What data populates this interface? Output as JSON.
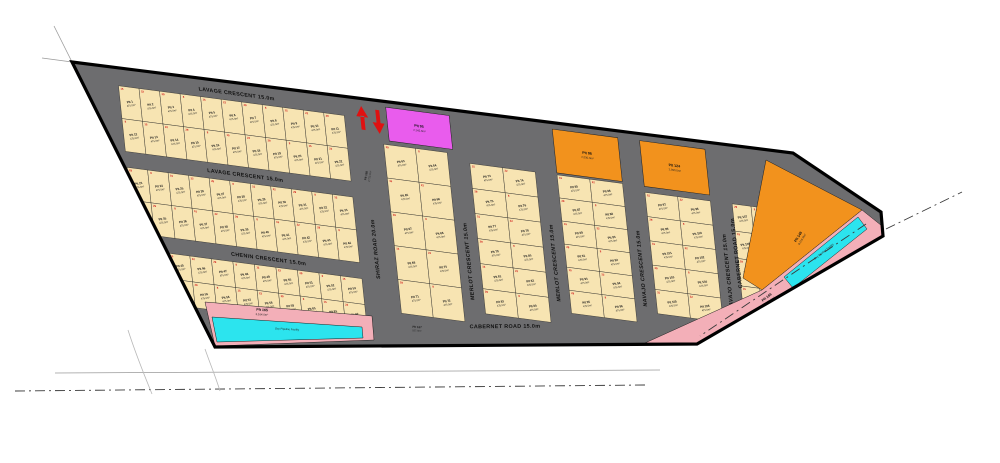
{
  "map": {
    "type": "subdivision-plat-plan",
    "canvas": {
      "width": 1000,
      "height": 463
    },
    "colors": {
      "background": "#ffffff",
      "road": "#6d6d6f",
      "lot_fill": "#f7e4b2",
      "lot_border": "#1f1f1f",
      "magenta": "#e95ced",
      "orange": "#f2921d",
      "pink": "#f3afb8",
      "cyan": "#2ce4ee",
      "red_mark": "#cf1010",
      "arrow_red": "#e01111",
      "boundary": "#000000",
      "survey_line": "#9a9a9a",
      "centerline": "#3a3a3a"
    },
    "boundary": {
      "points": [
        [
          72,
          62
        ],
        [
          793,
          153
        ],
        [
          881,
          212
        ],
        [
          883,
          236
        ],
        [
          697,
          344
        ],
        [
          215,
          347
        ]
      ],
      "stroke_width": 3.2
    },
    "grid_transform": {
      "matrix": [
        0.9914,
        0.1305,
        0.1045,
        0.9945,
        -5.86,
        -9.06
      ]
    },
    "lot": {
      "prefix": "Plt",
      "area_label": "475.0m²"
    },
    "blocks": [
      {
        "id": "lavage-north",
        "x": 117,
        "y": 80,
        "cols": 11,
        "rows": 2,
        "lot_w": 20.7,
        "lot_h": 33,
        "start": 1
      },
      {
        "id": "lavage-south",
        "x": 117,
        "y": 162,
        "cols": 11,
        "rows": 2,
        "lot_w": 20.7,
        "lot_h": 33,
        "start": 23
      },
      {
        "id": "chenin-block",
        "x": 150,
        "y": 244,
        "cols": 9,
        "rows": 2,
        "lot_w": 21.7,
        "lot_h": 26,
        "start": 45
      },
      {
        "id": "col-1",
        "x": 382,
        "y": 104,
        "cols": 2,
        "rows": 5,
        "lot_w": 32,
        "lot_h": 34,
        "start": 63
      },
      {
        "id": "col-2",
        "x": 468,
        "y": 112,
        "cols": 2,
        "rows": 6,
        "lot_w": 33,
        "lot_h": 25.2,
        "start": 73
      },
      {
        "id": "col-3",
        "x": 556,
        "y": 112,
        "cols": 2,
        "rows": 6,
        "lot_w": 33,
        "lot_h": 23.2,
        "start": 85
      },
      {
        "id": "col-4",
        "x": 644,
        "y": 118,
        "cols": 2,
        "rows": 5,
        "lot_w": 33,
        "lot_h": 24.4,
        "start": 97
      },
      {
        "id": "col-5",
        "x": 732,
        "y": 118,
        "cols": 2,
        "rows": 4,
        "lot_w": 19,
        "lot_h": 27.5,
        "start": 107
      }
    ],
    "street_labels_local": [
      {
        "name": "LAVAGE CRESCENT 15.0m",
        "x": 237,
        "y": 74,
        "rotate": 0
      },
      {
        "name": "LAVAGE CRESCENT 15.0m",
        "x": 237,
        "y": 156,
        "rotate": 0
      },
      {
        "name": "CHENIN CRESCENT 15.0m",
        "x": 252,
        "y": 238,
        "rotate": 0
      },
      {
        "name": "CHENIN CRESCENT 15.0m",
        "x": 268,
        "y": 305,
        "rotate": 0
      },
      {
        "name": "SHIRAZ ROAD 20.0m",
        "x": 364,
        "y": 212,
        "rotate": -90
      },
      {
        "name": "MERLOT CRESCENT 15.0m",
        "x": 458,
        "y": 212,
        "rotate": -90
      },
      {
        "name": "MERLOT CRESCENT 15.0m",
        "x": 546,
        "y": 202,
        "rotate": -90
      },
      {
        "name": "NAVAJO CRESCENT 15.0m",
        "x": 634,
        "y": 196,
        "rotate": -90
      },
      {
        "name": "NAVAJO CRESCENT 15.0m",
        "x": 722,
        "y": 188,
        "rotate": -90
      }
    ],
    "street_labels_screen": [
      {
        "name": "CABERNET ROAD 15.0m",
        "x": 738,
        "y": 253,
        "rotate": -97
      },
      {
        "name": "CABERNET ROAD 15.0m",
        "x": 505,
        "y": 328,
        "rotate": -0.5
      }
    ],
    "special_plots_local": [
      {
        "id": "magenta-plot",
        "fill": "magenta",
        "x": 388,
        "y": 66,
        "w": 64,
        "h": 34,
        "lines": [
          "Plt 95",
          "2,145.0m²"
        ]
      },
      {
        "id": "orange-plot-1",
        "fill": "orange",
        "x": 556,
        "y": 66,
        "w": 66,
        "h": 44,
        "lines": [
          "Plt 98",
          "2,030.0m²"
        ]
      },
      {
        "id": "orange-plot-2",
        "fill": "orange",
        "x": 644,
        "y": 66,
        "w": 66,
        "h": 46,
        "lines": [
          "Plt 124",
          "2,050.0m²"
        ]
      }
    ],
    "special_plots_screen": [
      {
        "id": "orange-plot-large",
        "fill": "orange",
        "points": [
          [
            766,
            160
          ],
          [
            862,
            210
          ],
          [
            762,
            290
          ],
          [
            743,
            278
          ]
        ],
        "label": {
          "x": 800,
          "y": 238,
          "rotate": -58,
          "lines": [
            "Plt 148",
            "8,216.0m²"
          ]
        }
      },
      {
        "id": "pink-plot-right",
        "fill": "pink",
        "points": [
          [
            862,
            210
          ],
          [
            882,
            226
          ],
          [
            882,
            237
          ],
          [
            697,
            344
          ],
          [
            645,
            343
          ],
          [
            762,
            290
          ]
        ],
        "label": {
          "x": 768,
          "y": 299,
          "rotate": -37,
          "lines": [
            "Plt 166",
            "5,871.0m²"
          ]
        }
      },
      {
        "id": "pipeline-strip-right",
        "fill": "cyan",
        "points": [
          [
            858,
            217
          ],
          [
            867,
            229
          ],
          [
            793,
            288
          ],
          [
            784,
            277
          ]
        ],
        "label": {
          "x": 825,
          "y": 253,
          "rotate": -38.7,
          "lines": [
            "Oxy Pipeline Facility"
          ]
        }
      },
      {
        "id": "pink-plot-left",
        "fill": "pink",
        "points": [
          [
            205,
            302
          ],
          [
            372,
            316
          ],
          [
            374,
            340
          ],
          [
            215,
            346
          ]
        ],
        "label": {
          "x": 262,
          "y": 312,
          "rotate": 4,
          "lines": [
            "Plt 165",
            "3,164.0m²"
          ]
        }
      },
      {
        "id": "pipeline-strip-left",
        "fill": "cyan",
        "points": [
          [
            212,
            317
          ],
          [
            362,
            327
          ],
          [
            363,
            338
          ],
          [
            217,
            342
          ]
        ],
        "label": {
          "x": 287,
          "y": 331,
          "rotate": 3,
          "lines": [
            "Oxy Pipeline Facility"
          ]
        }
      }
    ],
    "floating_labels_screen": [
      {
        "id": "plot-168",
        "x": 368,
        "y": 176,
        "rotate": -80,
        "lines": [
          "Plt 168",
          "2,723.0m²"
        ]
      },
      {
        "id": "plot-167",
        "x": 417,
        "y": 329,
        "rotate": 3,
        "lines": [
          "Plt 167",
          "557.0m²"
        ]
      }
    ],
    "arrows_local": [
      {
        "id": "red-arrow-up-icon",
        "dir": "up",
        "x": 363,
        "y": 68,
        "h": 24
      },
      {
        "id": "red-arrow-down-icon",
        "dir": "down",
        "x": 379,
        "y": 70,
        "h": 24
      }
    ],
    "external_lines": [
      {
        "id": "boundary-extension-left",
        "kind": "solid",
        "pts": [
          [
            54,
            26
          ],
          [
            72,
            62
          ]
        ]
      },
      {
        "id": "boundary-extension-top",
        "kind": "solid",
        "pts": [
          [
            42,
            58
          ],
          [
            72,
            62
          ]
        ]
      },
      {
        "id": "survey-line-bottom",
        "kind": "solid",
        "pts": [
          [
            55,
            373
          ],
          [
            660,
            370
          ]
        ]
      },
      {
        "id": "road-centerline-bottom",
        "kind": "dashdot",
        "pts": [
          [
            15,
            391
          ],
          [
            645,
            385
          ]
        ]
      },
      {
        "id": "survey-curve-1",
        "kind": "curve",
        "d": "M 128,330 C 135,352 143,372 152,394"
      },
      {
        "id": "survey-curve-2",
        "kind": "curve",
        "d": "M 205,349 C 211,366 216,378 220,391"
      },
      {
        "id": "pipeline-centerline-ext",
        "kind": "dashdot",
        "pts": [
          [
            886,
            229
          ],
          [
            962,
            192
          ]
        ]
      },
      {
        "id": "pipeline-centerline-in",
        "kind": "dashdot",
        "pts": [
          [
            866,
            224
          ],
          [
            700,
            336
          ]
        ]
      }
    ]
  }
}
